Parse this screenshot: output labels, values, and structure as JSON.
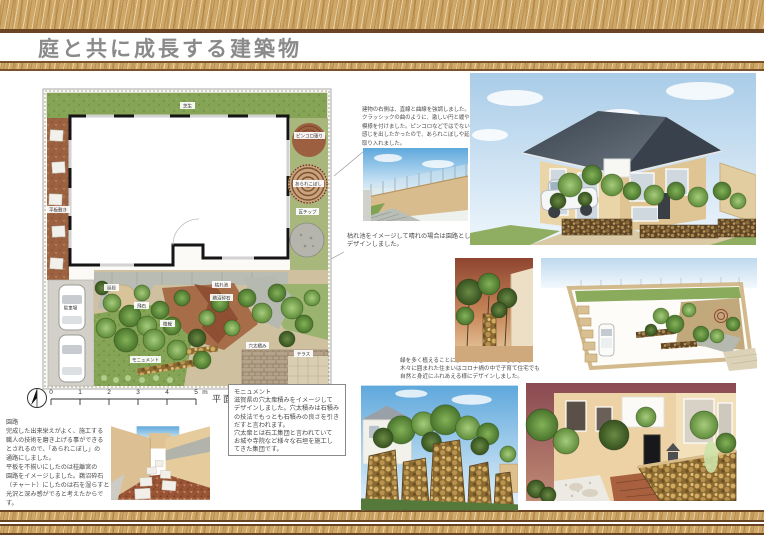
{
  "title": "庭と共に成長する建築物",
  "plan": {
    "caption": "平面図",
    "scale": "S=1:100",
    "scale_unit": "m",
    "scale_ticks": [
      "0",
      "1",
      "2",
      "3",
      "4",
      "5"
    ],
    "labels": [
      "芝生",
      "平板敷き",
      "駐車場",
      "ピンコロ張り",
      "あられこぼし",
      "瓦チップ",
      "鵜沼砕石",
      "枯れ池",
      "飛石",
      "延段",
      "植栽",
      "モニュメント",
      "穴太積み",
      "テラス"
    ]
  },
  "annotations": {
    "building_right": [
      "建物の右側は、直線と曲線を強調しました。",
      "クラッシックの曲のように、激しい円と緩やかな円で",
      "模様を付けました。ピンコロなどではでない自然な",
      "感じを出したかったので、あられこぼしや延べ段を",
      "取り入れました。"
    ],
    "dry_pond": [
      "枯れ池をイメージして晴れの場合は園路として活用して雨の場合は雨水が流れる様に",
      "デザインしました。"
    ],
    "monument": {
      "title": "モニュメント",
      "body": [
        "滋賀県の穴太衆積みをイメージして",
        "デザインしました。穴太積みは石積み",
        "の技法でもっとも石積みの良さを引き",
        "だすと言われます。",
        "穴太衆とは石工集団と言われていて",
        "お城や寺院など様々な石垣を施工し",
        "てきた集団です。"
      ]
    },
    "garden_path": {
      "title": "園路",
      "body": [
        "完成した出来栄えがよく、施工する",
        "職人の技術を磨き上げる事ができる",
        "とされるので、「あられこぼし」の",
        "通路にしました。",
        "平板を不揃いにしたのは桂離宮の",
        "園路をイメージしました。鵜沼砕石",
        "（チャート）にしたのは石を湿らすと",
        "光沢と深み感がでると考えたからです。"
      ]
    },
    "forest": [
      "緑を多く植えることによって森をイメージしました。",
      "木々に囲まれた住まいはコロナ禍の中で子育て住宅でも",
      "自然と身近にふれあえる様にデザインしました。"
    ]
  },
  "colors": {
    "wood": "#cfa767",
    "wood_edge": "#6b4423",
    "title_gray": "#8a8a8a",
    "lawn": "#85a455",
    "soil_brown": "#9c6b48",
    "stone_gray": "#b8bcb2",
    "wall_tan": "#d9bc8e",
    "roof_slate": "#49525c"
  }
}
